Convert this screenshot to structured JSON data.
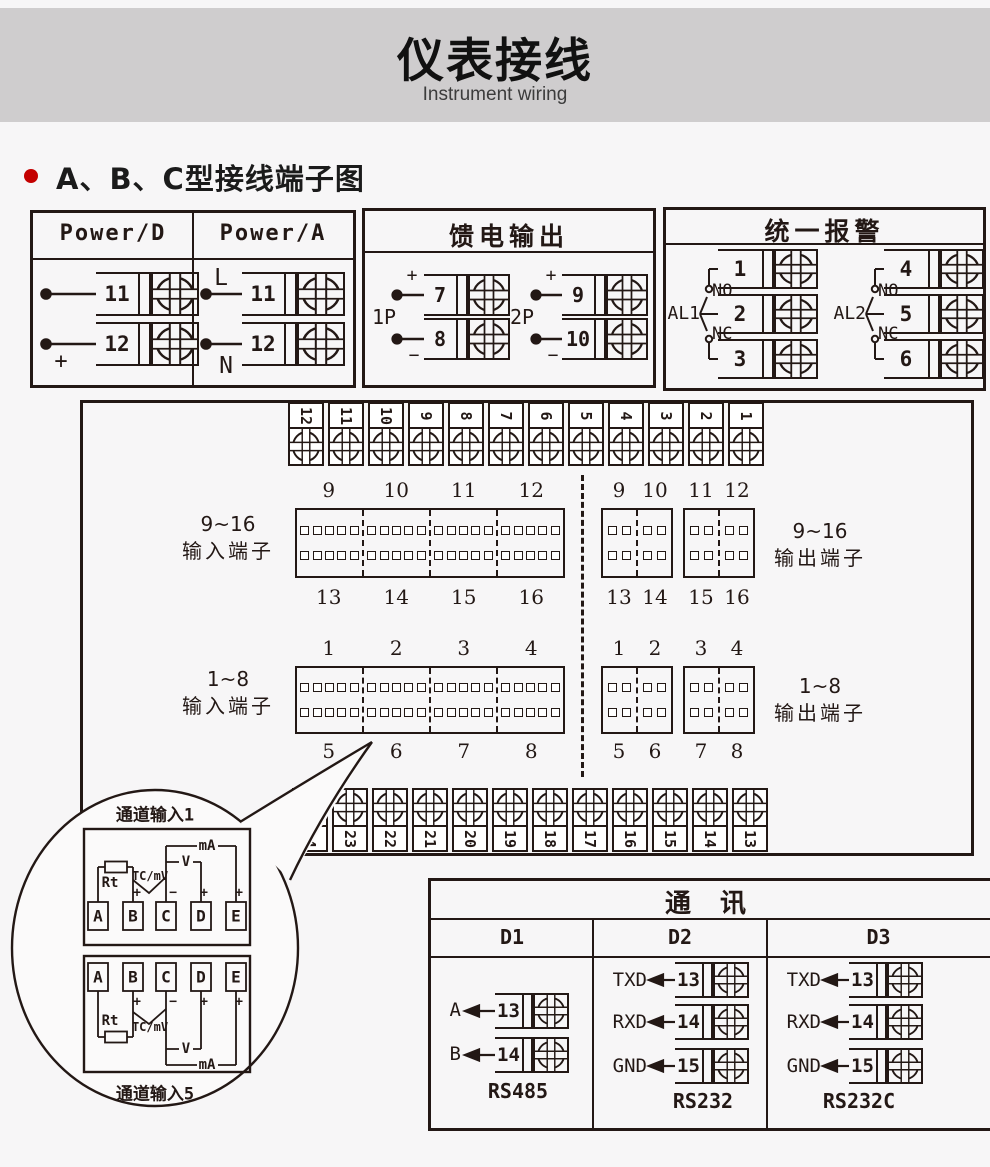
{
  "page": {
    "background": "#f7f6f7",
    "line_color": "#231815"
  },
  "header": {
    "title": "仪表接线",
    "subtitle": "Instrument wiring",
    "band_color": "#cfcdce"
  },
  "section": {
    "bullet_color": "#c40000",
    "heading": "A、B、C型接线端子图"
  },
  "power_box": {
    "columns": [
      {
        "title": "Power/D",
        "terminals": [
          {
            "label": "−",
            "num": "11"
          },
          {
            "label": "+",
            "num": "12"
          }
        ]
      },
      {
        "title": "Power/A",
        "terminals": [
          {
            "label": "L",
            "num": "11"
          },
          {
            "label": "N",
            "num": "12"
          }
        ]
      }
    ]
  },
  "feed_box": {
    "title": "馈电输出",
    "groups": [
      {
        "name": "1P",
        "top_sign": "+",
        "bottom_sign": "−",
        "top_num": "7",
        "bottom_num": "8"
      },
      {
        "name": "2P",
        "top_sign": "+",
        "bottom_sign": "−",
        "top_num": "9",
        "bottom_num": "10"
      }
    ]
  },
  "alarm_box": {
    "title": "统一报警",
    "groups": [
      {
        "name": "AL1",
        "no": "NO",
        "nc": "NC",
        "nums": [
          "1",
          "2",
          "3"
        ]
      },
      {
        "name": "AL2",
        "no": "NO",
        "nc": "NC",
        "nums": [
          "4",
          "5",
          "6"
        ]
      }
    ]
  },
  "main_board": {
    "top_strip": [
      "12",
      "11",
      "10",
      "9",
      "8",
      "7",
      "6",
      "5",
      "4",
      "3",
      "2",
      "1"
    ],
    "bottom_strip": [
      "24",
      "23",
      "22",
      "21",
      "20",
      "19",
      "18",
      "17",
      "16",
      "15",
      "14",
      "13"
    ],
    "input916": {
      "line1": "9~16",
      "line2": "输入端子",
      "top": [
        "9",
        "10",
        "11",
        "12"
      ],
      "bottom": [
        "13",
        "14",
        "15",
        "16"
      ]
    },
    "output916": {
      "line1": "9~16",
      "line2": "输出端子",
      "top": [
        "9",
        "10",
        "11",
        "12"
      ],
      "bottom": [
        "13",
        "14",
        "15",
        "16"
      ]
    },
    "input18": {
      "line1": "1~8",
      "line2": "输入端子",
      "top": [
        "1",
        "2",
        "3",
        "4"
      ],
      "bottom": [
        "5",
        "6",
        "7",
        "8"
      ]
    },
    "output18": {
      "line1": "1~8",
      "line2": "输出端子",
      "top": [
        "1",
        "2",
        "3",
        "4"
      ],
      "bottom": [
        "5",
        "6",
        "7",
        "8"
      ]
    }
  },
  "balloon": {
    "top_label": "通道输入1",
    "bottom_label": "通道输入5",
    "plus": "+",
    "minus": "−",
    "channel1": {
      "terminals": [
        "A",
        "B",
        "C",
        "D",
        "E"
      ],
      "rt": "Rt",
      "tc": "TC/mV",
      "v": "V",
      "ma": "mA"
    },
    "channel5": {
      "terminals": [
        "A",
        "B",
        "C",
        "D",
        "E"
      ],
      "rt": "Rt",
      "tc": "TC/mV",
      "v": "V",
      "ma": "mA"
    }
  },
  "comm_box": {
    "title": "通 讯",
    "columns": [
      {
        "header": "D1",
        "standard": "RS485",
        "rows": [
          {
            "signal": "A",
            "num": "13"
          },
          {
            "signal": "B",
            "num": "14"
          }
        ]
      },
      {
        "header": "D2",
        "standard": "RS232",
        "rows": [
          {
            "signal": "TXD",
            "num": "13"
          },
          {
            "signal": "RXD",
            "num": "14"
          },
          {
            "signal": "GND",
            "num": "15"
          }
        ]
      },
      {
        "header": "D3",
        "standard": "RS232C",
        "rows": [
          {
            "signal": "TXD",
            "num": "13"
          },
          {
            "signal": "RXD",
            "num": "14"
          },
          {
            "signal": "GND",
            "num": "15"
          }
        ]
      }
    ]
  }
}
